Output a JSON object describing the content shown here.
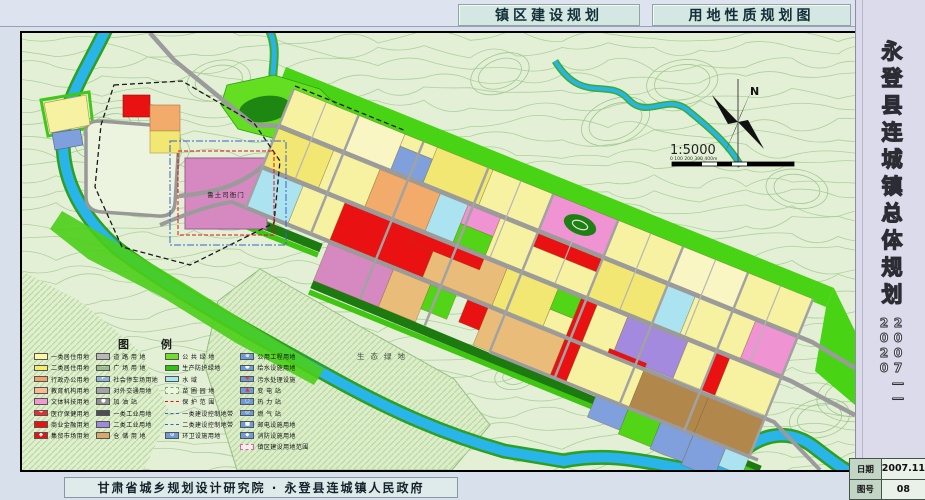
{
  "header": {
    "title_left": "镇区建设规划",
    "title_right": "用地性质规划图"
  },
  "sidebar": {
    "title": "永登县连城镇总体规划",
    "period": "2007——2020",
    "table": {
      "date_label": "日期",
      "date_value": "2007.11",
      "sheet_label": "图号",
      "sheet_value": "08"
    }
  },
  "footer": {
    "credit": "甘肃省城乡规划设计研究院 · 永登县连城镇人民政府"
  },
  "map": {
    "labels": {
      "eco": "生态绿地",
      "heritage": "鲁土司衙门",
      "north": "N",
      "scale": "1:5000",
      "scale_ticks": "0    100    200   300   400m"
    },
    "colors": {
      "residential_1": "#f7f1a2",
      "residential_2": "#f2e772",
      "admin_office": "#f2ab6a",
      "commercial": "#e91111",
      "culture": "#ef93d2",
      "industry_2": "#a38ade",
      "warehouse": "#e9bd79",
      "green_space": "#53d517",
      "water": "#29b4ea",
      "road": "#9b9b9b"
    },
    "legend": {
      "title": "图    例",
      "columns": [
        {
          "items": [
            {
              "label": "一类居住用地",
              "sw": {
                "t": "fill",
                "bg": "#fdf7a6"
              }
            },
            {
              "label": "二类居住用地",
              "sw": {
                "t": "fill",
                "bg": "#f5ec6a"
              }
            },
            {
              "label": "行政办公用地",
              "sw": {
                "t": "fill",
                "bg": "#f2a368"
              }
            },
            {
              "label": "教育机构用地",
              "sw": {
                "t": "fill",
                "bg": "#f7bc92"
              }
            },
            {
              "label": "文体科技用地",
              "sw": {
                "t": "fill",
                "bg": "#f09ad2"
              }
            },
            {
              "label": "医疗保健用地",
              "sw": {
                "t": "fill",
                "bg": "#e92c2c",
                "sym": "+",
                "symc": "#ffffff"
              }
            },
            {
              "label": "商业金融用地",
              "sw": {
                "t": "fill",
                "bg": "#e91212"
              }
            },
            {
              "label": "集贸市场用地",
              "sw": {
                "t": "fill",
                "bg": "#e91212",
                "sym": "◆",
                "symc": "#ffffff"
              }
            }
          ]
        },
        {
          "items": [
            {
              "label": "道 路 用 地",
              "sw": {
                "t": "fill",
                "bg": "#b9b9b9"
              }
            },
            {
              "label": "广 场 用 地",
              "sw": {
                "t": "fill",
                "bg": "#9cbb8e",
                "sym": "∙∙",
                "symc": "#ffffff"
              }
            },
            {
              "label": "社会停车场用地",
              "sw": {
                "t": "fill",
                "bg": "#8cb4dc",
                "sym": "P",
                "symc": "#ffffff"
              }
            },
            {
              "label": "对外交通用地",
              "sw": {
                "t": "fill",
                "bg": "#a3a3a3"
              }
            },
            {
              "label": "加 油 站",
              "sw": {
                "t": "fill",
                "bg": "#8f8f8f",
                "sym": "●",
                "symc": "#ffffff"
              }
            },
            {
              "label": "一类工业用地",
              "sw": {
                "t": "fill",
                "bg": "#4c5052"
              }
            },
            {
              "label": "二类工业用地",
              "sw": {
                "t": "fill",
                "bg": "#a188dd"
              }
            },
            {
              "label": "仓 储 用 地",
              "sw": {
                "t": "fill",
                "bg": "#d8a968"
              }
            }
          ]
        },
        {
          "items": [
            {
              "label": "公 共 绿 地",
              "sw": {
                "t": "fill",
                "bg": "#6fe02a"
              }
            },
            {
              "label": "生产防护绿地",
              "sw": {
                "t": "fill",
                "bg": "#2cc40e"
              }
            },
            {
              "label": "水       域",
              "sw": {
                "t": "fill",
                "bg": "#a9e6f2"
              }
            },
            {
              "label": "苗 圃 园 地",
              "sw": {
                "t": "dash",
                "bg": "#eef6e2",
                "bc": "#7aa86a"
              }
            },
            {
              "label": "保 护 范 围",
              "sw": {
                "t": "line",
                "lc": "#e91212",
                "ls": "dashed"
              }
            },
            {
              "label": "一类建设控制地带",
              "sw": {
                "t": "line",
                "lc": "#3a62c8",
                "ls": "dashdot"
              }
            },
            {
              "label": "二类建设控制地带",
              "sw": {
                "t": "line",
                "lc": "#3a62c8",
                "ls": "dashed"
              }
            },
            {
              "label": "环卫设施用地",
              "sw": {
                "t": "fill",
                "bg": "#6f9ad8",
                "sym": "⊙",
                "symc": "#ffffff"
              }
            }
          ]
        },
        {
          "items": [
            {
              "label": "公用工程用地",
              "sw": {
                "t": "fill",
                "bg": "#6f9ad8",
                "sym": "⊕",
                "symc": "#ffffff"
              }
            },
            {
              "label": "给水设施用地",
              "sw": {
                "t": "fill",
                "bg": "#6f9ad8",
                "sym": "●",
                "symc": "#ffffff"
              }
            },
            {
              "label": "污水处理设施",
              "sw": {
                "t": "fill",
                "bg": "#6f9ad8",
                "sym": "◉",
                "symc": "#e93030"
              }
            },
            {
              "label": "变 电 站",
              "sw": {
                "t": "fill",
                "bg": "#6f9ad8",
                "sym": "▲",
                "symc": "#e93030"
              }
            },
            {
              "label": "热 力 站",
              "sw": {
                "t": "fill",
                "bg": "#6f9ad8",
                "sym": "○",
                "symc": "#ffffff"
              }
            },
            {
              "label": "燃 气 站",
              "sw": {
                "t": "fill",
                "bg": "#6f9ad8",
                "sym": "◎",
                "symc": "#ffffff"
              }
            },
            {
              "label": "邮电设施用地",
              "sw": {
                "t": "fill",
                "bg": "#6f9ad8",
                "sym": "■",
                "symc": "#ffffff"
              }
            },
            {
              "label": "消防设施用地",
              "sw": {
                "t": "fill",
                "bg": "#6f9ad8",
                "sym": "◆",
                "symc": "#ffffff"
              }
            },
            {
              "label": "镇区建设用地范围",
              "sw": {
                "t": "dashrect",
                "bg": "#f3efe6",
                "bc": "#d06ab0"
              }
            }
          ]
        }
      ]
    }
  }
}
